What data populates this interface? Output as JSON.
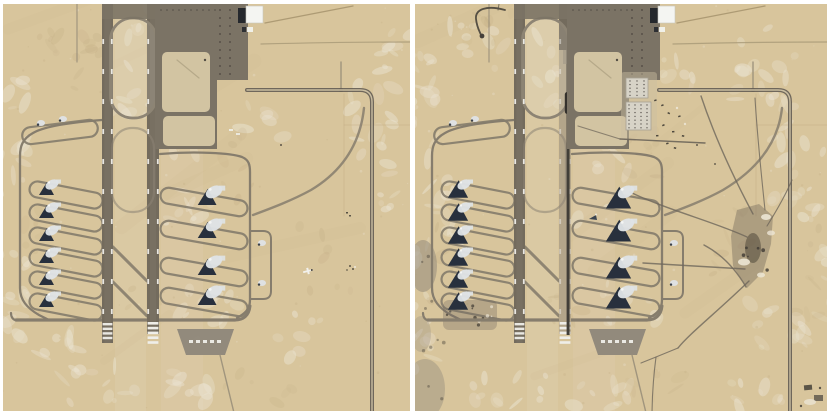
{
  "figure": {
    "type": "satellite-comparison",
    "background": "#ffffff"
  },
  "colors": {
    "sand": "#d8c59c",
    "sand_light": "#ebe4d3",
    "sand_dark": "#c3ae85",
    "runway": "#736b5d",
    "runway_faded": "#c1b294",
    "oval_stroke": "#8d8474",
    "taxiway": "#867d6d",
    "taxiway_thin": "#9a8f7a",
    "apron": "#7b7365",
    "apron_light": "#d2c4a2",
    "dot_dark": "#45403a",
    "hangar_white": "#f4f5f2",
    "hangar_dark": "#25282d",
    "shelter_white": "#dfe3e6",
    "shelter_dark": "#28303d",
    "mark_white": "#efeee9",
    "pad_gray": "#8e877a",
    "road_dark": "#696257",
    "road_center": "#cfc2a4",
    "trench": "#413e38",
    "trench_blob": "#34312c",
    "track": "#6e675b",
    "excavation": "#6e6557",
    "excavation_core": "#50483a",
    "spoil_white": "#ece5d4",
    "building_gray": "#d7d3c7",
    "building_stroke": "#a8a294",
    "vehicle_dark": "#3e3a33",
    "patch_dark": "#8d8577",
    "hook_road": "#565044"
  },
  "scene": {
    "runway1": {
      "x": 99,
      "w": 11,
      "y_end": 339
    },
    "runway2": {
      "x": 144,
      "w": 12,
      "y_end": 330
    },
    "marking_ys": [
      35,
      65,
      95,
      125,
      155,
      185,
      215,
      245,
      275,
      305
    ],
    "west_shelter_rows_y": [
      183,
      206,
      229,
      251,
      273,
      295
    ],
    "east_shelter_rows_y": [
      191,
      224,
      261,
      291
    ],
    "east_small_shelters_y": [
      239,
      279
    ],
    "west_small_shelters": [
      [
        38,
        119
      ],
      [
        60,
        115
      ]
    ],
    "bottom_taxiway_y": 316,
    "hangar": {
      "x": 243,
      "y": 2,
      "w": 17,
      "h": 17
    },
    "counts": {
      "west_large_shelters": 6,
      "west_small_shelters": 2,
      "east_large_shelters": 4,
      "east_small_shelters": 2,
      "runways": 2
    }
  },
  "panels": [
    {
      "name": "left-satellite-image",
      "width": 407,
      "height": 407,
      "seed": 7,
      "perimeter_road_x": 369,
      "shadow_scale": 1.0,
      "features": {
        "hook_road": false,
        "runway_trench": false,
        "runway2_faded": false,
        "construction_buildings": false,
        "track_network": false,
        "excavation": false,
        "dark_edge_patches": false,
        "comb_speckle_patch": false,
        "field_aircraft_white": true,
        "field_aircraft_dark": false,
        "corner_structures": false
      },
      "mottle_light": [
        [
          8,
          130,
          14,
          70,
          16
        ],
        [
          10,
          285,
          15,
          55,
          14
        ],
        [
          126,
          68,
          20,
          48,
          10
        ],
        [
          180,
          178,
          28,
          55,
          12
        ],
        [
          205,
          312,
          33,
          26,
          10
        ],
        [
          92,
          382,
          42,
          20,
          12
        ],
        [
          182,
          386,
          28,
          18,
          9
        ],
        [
          372,
          140,
          26,
          75,
          18
        ],
        [
          392,
          62,
          18,
          38,
          10
        ],
        [
          300,
          332,
          26,
          22,
          7
        ],
        [
          152,
          18,
          18,
          12,
          6
        ],
        [
          56,
          344,
          22,
          13,
          7
        ],
        [
          260,
          120,
          20,
          25,
          6
        ]
      ],
      "mottle_dark": [
        [
          52,
          30,
          38,
          22,
          8
        ],
        [
          86,
          62,
          16,
          36,
          7
        ],
        [
          232,
          162,
          22,
          36,
          7
        ],
        [
          322,
          252,
          36,
          36,
          7
        ],
        [
          140,
          302,
          18,
          18,
          5
        ],
        [
          30,
          222,
          13,
          36,
          6
        ],
        [
          250,
          380,
          40,
          20,
          6
        ]
      ],
      "tracks": []
    },
    {
      "name": "right-satellite-image",
      "width": 412,
      "height": 407,
      "seed": 13,
      "perimeter_road_x": 375,
      "shadow_scale": 1.35,
      "features": {
        "hook_road": true,
        "runway_trench": true,
        "runway2_faded": true,
        "construction_buildings": true,
        "track_network": true,
        "excavation": true,
        "dark_edge_patches": true,
        "comb_speckle_patch": true,
        "field_aircraft_white": false,
        "field_aircraft_dark": true,
        "corner_structures": true
      },
      "mottle_light": [
        [
          8,
          118,
          13,
          85,
          18
        ],
        [
          6,
          302,
          13,
          65,
          16
        ],
        [
          62,
          40,
          28,
          26,
          10
        ],
        [
          142,
          74,
          22,
          42,
          10
        ],
        [
          186,
          172,
          28,
          48,
          12
        ],
        [
          212,
          302,
          32,
          26,
          10
        ],
        [
          96,
          386,
          42,
          18,
          11
        ],
        [
          186,
          390,
          28,
          16,
          9
        ],
        [
          348,
          60,
          32,
          42,
          16
        ],
        [
          382,
          150,
          26,
          68,
          18
        ],
        [
          362,
          322,
          28,
          38,
          12
        ],
        [
          256,
          60,
          22,
          22,
          9
        ],
        [
          334,
          392,
          36,
          16,
          9
        ],
        [
          36,
          212,
          16,
          46,
          9
        ],
        [
          406,
          250,
          12,
          70,
          10
        ]
      ],
      "mottle_dark": [
        [
          62,
          26,
          36,
          18,
          8
        ],
        [
          232,
          152,
          22,
          32,
          7
        ],
        [
          320,
          232,
          28,
          38,
          8
        ],
        [
          152,
          302,
          18,
          22,
          6
        ],
        [
          28,
          262,
          13,
          42,
          7
        ],
        [
          392,
          262,
          12,
          55,
          7
        ],
        [
          250,
          384,
          36,
          18,
          6
        ]
      ],
      "tracks": [
        "M286,92 C302,140 322,180 338,210",
        "M215,188 C252,206 300,218 332,233",
        "M228,259 L330,265",
        "M289,241 C306,250 320,264 331,283",
        "M334,277 C302,308 274,330 263,344",
        "M263,344 L241,353 L226,359",
        "M241,353 C238,376 237,396 237,413",
        "M352,222 C362,206 371,190 377,176",
        "M350,206 C346,168 342,128 340,94"
      ]
    }
  ]
}
